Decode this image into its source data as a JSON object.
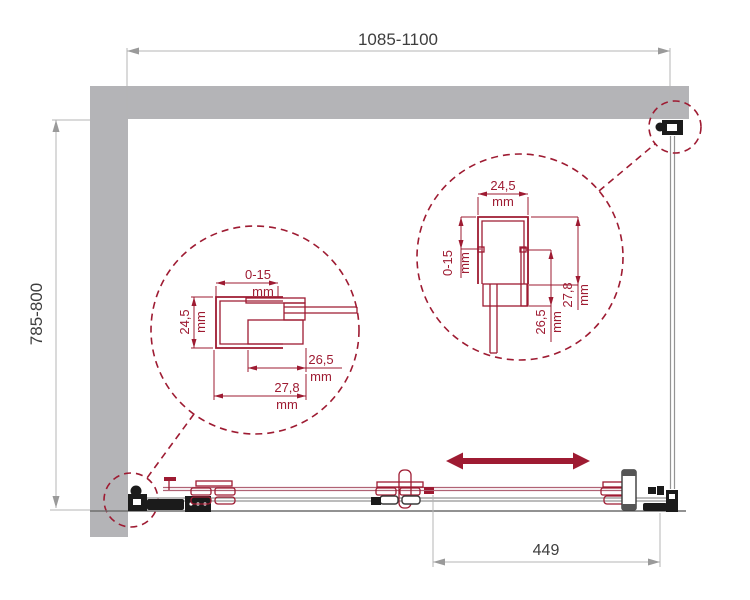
{
  "dimensions": {
    "width": "1085-1100",
    "depth": "785-800",
    "travel": "449"
  },
  "details": {
    "unit": "mm",
    "left": {
      "top": "0-15",
      "side": "24,5",
      "inner": "26,5",
      "outer": "27,8"
    },
    "right": {
      "top": "24,5",
      "side": "0-15",
      "inner": "26,5",
      "outer": "27,8"
    }
  },
  "colors": {
    "accent_maroon": "#9e1b32",
    "wall_gray": "#b4b4b7",
    "dimension_gray": "#b5b5b5",
    "text_dark": "#3e3e3e"
  }
}
